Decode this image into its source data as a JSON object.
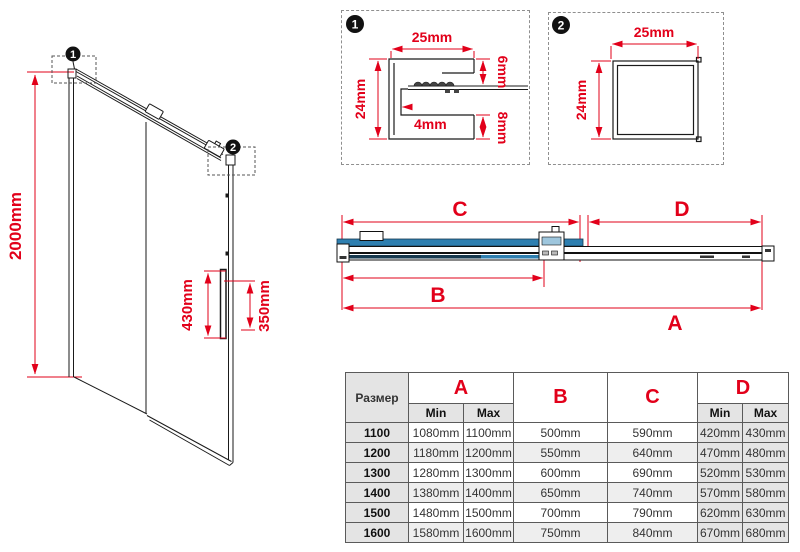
{
  "colors": {
    "dimension_red": "#e2001a",
    "glass_blue": "#2e7fb0",
    "glass_navy": "#16394f",
    "table_gray": "#e4e4e4",
    "row_alt_gray": "#eeeeee",
    "line_black": "#1a1a1a"
  },
  "left_diagram": {
    "marker1": "1",
    "marker2": "2",
    "dim_height": "2000mm",
    "dim_handle_left": "430mm",
    "dim_handle_right": "350mm"
  },
  "detail1": {
    "marker": "1",
    "dim_width": "25mm",
    "dim_height": "24mm",
    "dim_wall": "4mm",
    "dim_top": "6mm",
    "dim_bottom": "8mm"
  },
  "detail2": {
    "marker": "2",
    "dim_width": "25mm",
    "dim_height": "24mm"
  },
  "section": {
    "dim_a": "A",
    "dim_b": "B",
    "dim_c": "C",
    "dim_d": "D"
  },
  "table": {
    "size_header": "Размер",
    "col_a": "A",
    "col_b": "B",
    "col_c": "C",
    "col_d": "D",
    "min": "Min",
    "max": "Max",
    "rows": [
      {
        "size": "1100",
        "a_min": "1080mm",
        "a_max": "1100mm",
        "b": "500mm",
        "c": "590mm",
        "d_min": "420mm",
        "d_max": "430mm"
      },
      {
        "size": "1200",
        "a_min": "1180mm",
        "a_max": "1200mm",
        "b": "550mm",
        "c": "640mm",
        "d_min": "470mm",
        "d_max": "480mm"
      },
      {
        "size": "1300",
        "a_min": "1280mm",
        "a_max": "1300mm",
        "b": "600mm",
        "c": "690mm",
        "d_min": "520mm",
        "d_max": "530mm"
      },
      {
        "size": "1400",
        "a_min": "1380mm",
        "a_max": "1400mm",
        "b": "650mm",
        "c": "740mm",
        "d_min": "570mm",
        "d_max": "580mm"
      },
      {
        "size": "1500",
        "a_min": "1480mm",
        "a_max": "1500mm",
        "b": "700mm",
        "c": "790mm",
        "d_min": "620mm",
        "d_max": "630mm"
      },
      {
        "size": "1600",
        "a_min": "1580mm",
        "a_max": "1600mm",
        "b": "750mm",
        "c": "840mm",
        "d_min": "670mm",
        "d_max": "680mm"
      }
    ]
  }
}
